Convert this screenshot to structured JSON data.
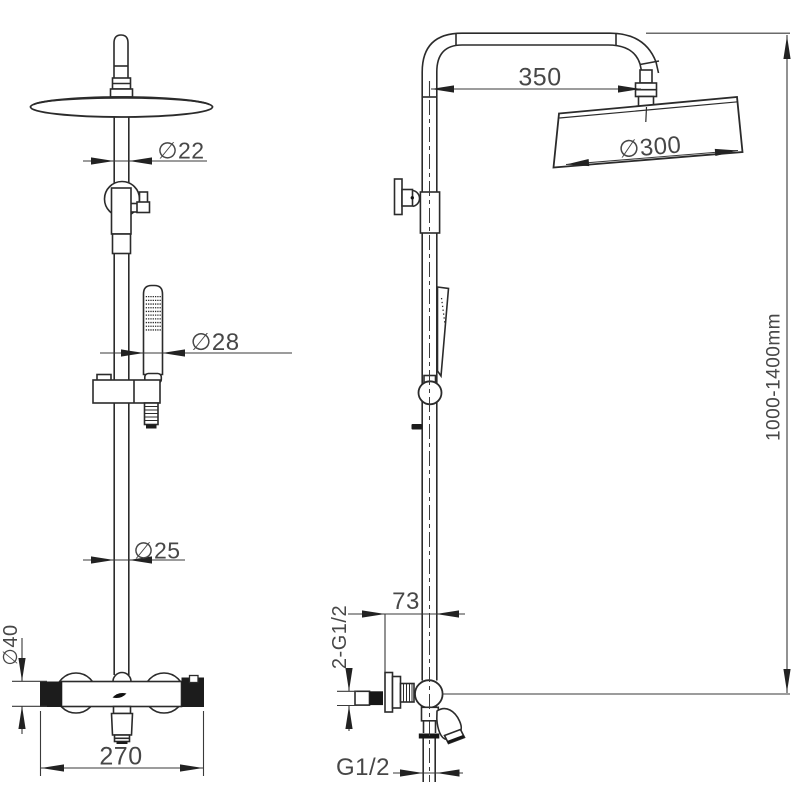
{
  "style": {
    "background": "#ffffff",
    "line_color": "#2b2b2b",
    "dimension_color": "#3a3a3a",
    "text_color": "#474747",
    "fill_black": "#1c1c1c"
  },
  "dimensions": {
    "front": {
      "arm_pipe_diameter": "∅22",
      "hand_shower_diameter": "∅28",
      "riser_pipe_diameter": "∅25",
      "valve_body_diameter": "∅40",
      "valve_width": "270"
    },
    "side": {
      "arm_projection": "350",
      "head_diameter": "∅300",
      "height_range": "1000-1400mm",
      "wall_offset": "73",
      "inlet_thread": "2-G1/2",
      "outlet_thread": "G1/2"
    }
  }
}
